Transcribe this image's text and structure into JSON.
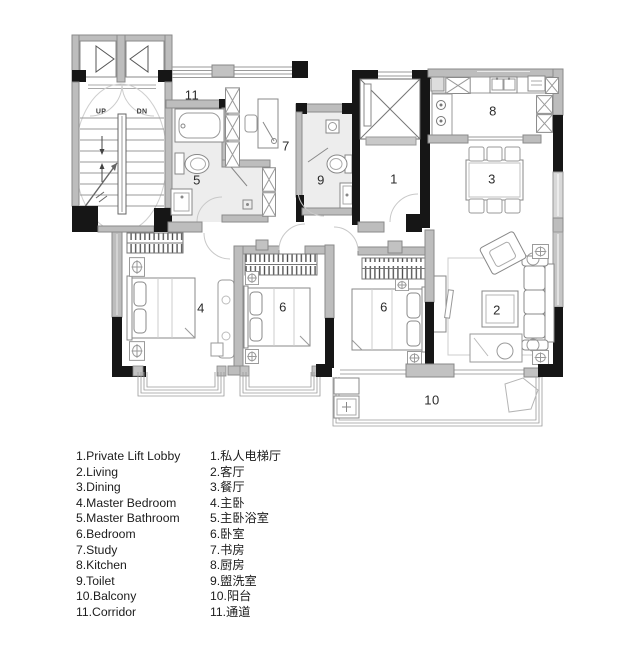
{
  "plan": {
    "rooms": [
      {
        "id": "lift-lobby",
        "num": "1"
      },
      {
        "id": "living",
        "num": "2"
      },
      {
        "id": "dining",
        "num": "3"
      },
      {
        "id": "master-bedroom",
        "num": "4"
      },
      {
        "id": "master-bathroom",
        "num": "5"
      },
      {
        "id": "bedroom-left",
        "num": "6"
      },
      {
        "id": "bedroom-right",
        "num": "6"
      },
      {
        "id": "study",
        "num": "7"
      },
      {
        "id": "kitchen",
        "num": "8"
      },
      {
        "id": "toilet",
        "num": "9"
      },
      {
        "id": "balcony",
        "num": "10"
      },
      {
        "id": "corridor",
        "num": "11"
      }
    ],
    "stairs": {
      "up": "UP",
      "dn": "DN"
    },
    "colors": {
      "wall_black": "#161616",
      "wall_gray": "#bdbdbd",
      "room_tint": "#ededed",
      "line": "#8a8a8a"
    }
  },
  "legend": {
    "en": [
      "1.Private Lift Lobby",
      "2.Living",
      "3.Dining",
      "4.Master Bedroom",
      "5.Master Bathroom",
      "6.Bedroom",
      "7.Study",
      "8.Kitchen",
      "9.Toilet",
      "10.Balcony",
      "11.Corridor"
    ],
    "zh": [
      "1.私人电梯厅",
      "2.客厅",
      "3.餐厅",
      "4.主卧",
      "5.主卧浴室",
      "6.卧室",
      "7.书房",
      "8.厨房",
      "9.盥洗室",
      "10.阳台",
      "11.通道"
    ]
  }
}
